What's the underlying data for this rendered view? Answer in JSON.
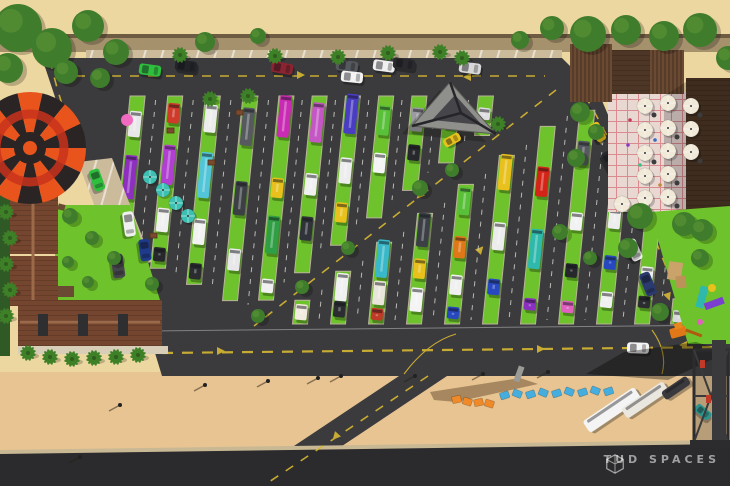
{
  "watermark": {
    "text": "TUD SPACES",
    "logo": "cube-outline-icon"
  },
  "palette": {
    "sand": "#ecd7a0",
    "beach": "#e7c492",
    "asphalt": "#3b3b3d",
    "asphalt_dark": "#2b2b2d",
    "grass": "#6ec22b",
    "concrete": "#cbbb9b",
    "wall": "#a5916c",
    "wall_edge": "#6d5c42",
    "roof_brown": "#74452f",
    "roof_dark": "#3e2c1e",
    "wood_slat": "#6b4a33",
    "plaza": "#e9d8d2",
    "plaza_line": "#d6787f",
    "lane_yellow": "#d8b832",
    "hedge": "#2f5a26",
    "tree": "#3f7d2c",
    "palm": "#3e8027",
    "umbrella_teal": "#3cc0b4",
    "umbrella_white": "#f0e9d8",
    "balloon_orange": "#e8541c",
    "balloon_dark": "#2a2524",
    "balloon_ring": "#c8321c",
    "letter_blue": "#45aede",
    "letter_orange": "#f08a28",
    "curb": "#c9b894",
    "sidewalk": "#d8cdb6"
  },
  "scene": {
    "balloon": {
      "cx": 30,
      "cy": 148,
      "r": 56,
      "gores": 14
    },
    "upper_grid": {
      "lean": 0.1,
      "strips": [
        {
          "x": 122,
          "t": [
            [
              0.18,
              26,
              "#e8e8ea"
            ],
            [
              0.52,
              44,
              "#8e2fc0"
            ],
            [
              0.85,
              18,
              "#2b2d31"
            ]
          ]
        },
        {
          "x": 158,
          "t": [
            [
              0.1,
              20,
              "#cf3a2a"
            ],
            [
              0.4,
              40,
              "#b13fd1"
            ],
            [
              0.72,
              24,
              "#f0f0f0"
            ],
            [
              0.92,
              14,
              "#26282c"
            ]
          ]
        },
        {
          "x": 194,
          "t": [
            [
              0.12,
              28,
              "#ececec"
            ],
            [
              0.42,
              46,
              "#52c6d8"
            ],
            [
              0.72,
              26,
              "#f2f2f2"
            ],
            [
              0.93,
              16,
              "#2a2c30"
            ]
          ]
        },
        {
          "x": 230,
          "t": [
            [
              0.15,
              38,
              "#565a5e"
            ],
            [
              0.5,
              34,
              "#3c4044"
            ],
            [
              0.8,
              22,
              "#e8e8ea"
            ]
          ]
        },
        {
          "x": 266,
          "t": [
            [
              0.1,
              42,
              "#c92bb4"
            ],
            [
              0.45,
              20,
              "#e8c11c"
            ],
            [
              0.68,
              38,
              "#2f9e44"
            ],
            [
              0.93,
              14,
              "#f0f0f0"
            ]
          ]
        },
        {
          "x": 302,
          "t": [
            [
              0.15,
              40,
              "#c457c4"
            ],
            [
              0.5,
              22,
              "#f0f0f0"
            ],
            [
              0.75,
              24,
              "#30343a"
            ]
          ]
        },
        {
          "x": 338,
          "t": [
            [
              0.12,
              40,
              "#4a3dc2"
            ],
            [
              0.5,
              26,
              "#ededed"
            ],
            [
              0.78,
              20,
              "#e8c11c"
            ]
          ]
        },
        {
          "x": 374,
          "t": [
            [
              0.2,
              30,
              "#59c03a"
            ],
            [
              0.55,
              20,
              "#f4f4f4"
            ]
          ]
        },
        {
          "x": 410,
          "t": [
            [
              0.25,
              24,
              "#9a9aa0"
            ],
            [
              0.6,
              16,
              "#26282c"
            ]
          ]
        },
        {
          "x": 446,
          "t": [
            [
              0.35,
              18,
              "#f0f0f0"
            ]
          ]
        },
        {
          "x": 482,
          "t": [
            [
              0.45,
              12,
              "#e0e0e2"
            ]
          ]
        }
      ]
    },
    "lower_grid": {
      "lean": 0.1,
      "strips": [
        {
          "x": 300,
          "t": [
            [
              0.5,
              20,
              "#f2ece0"
            ]
          ]
        },
        {
          "x": 338,
          "t": [
            [
              0.3,
              28,
              "#f0f0f0"
            ],
            [
              0.72,
              16,
              "#2b2d31"
            ]
          ]
        },
        {
          "x": 376,
          "t": [
            [
              0.2,
              38,
              "#38b8c8"
            ],
            [
              0.62,
              24,
              "#e9e5da"
            ],
            [
              0.88,
              12,
              "#c03a28"
            ]
          ]
        },
        {
          "x": 414,
          "t": [
            [
              0.15,
              34,
              "#3c4046"
            ],
            [
              0.5,
              20,
              "#e8c11c"
            ],
            [
              0.78,
              24,
              "#f4f4f4"
            ]
          ]
        },
        {
          "x": 452,
          "t": [
            [
              0.12,
              28,
              "#59c03a"
            ],
            [
              0.45,
              22,
              "#e07818"
            ],
            [
              0.72,
              20,
              "#f0f0f0"
            ],
            [
              0.92,
              12,
              "#2848c0"
            ]
          ]
        },
        {
          "x": 490,
          "t": [
            [
              0.1,
              36,
              "#e8c11c"
            ],
            [
              0.48,
              28,
              "#ececec"
            ],
            [
              0.78,
              16,
              "#2848c0"
            ]
          ]
        },
        {
          "x": 528,
          "t": [
            [
              0.28,
              30,
              "#d42418"
            ],
            [
              0.62,
              40,
              "#2fb9ac"
            ],
            [
              0.9,
              12,
              "#8a2fc0"
            ]
          ]
        },
        {
          "x": 566,
          "t": [
            [
              0.2,
              24,
              "#565a5e"
            ],
            [
              0.52,
              18,
              "#f2f2f2"
            ],
            [
              0.75,
              14,
              "#26282c"
            ],
            [
              0.92,
              12,
              "#e060c0"
            ]
          ]
        },
        {
          "x": 604,
          "t": [
            [
              0.35,
              20,
              "#ededed"
            ],
            [
              0.62,
              14,
              "#2848c0"
            ],
            [
              0.85,
              16,
              "#f0f0f0"
            ]
          ]
        },
        {
          "x": 642,
          "t": [
            [
              0.55,
              16,
              "#f0f0f0"
            ],
            [
              0.8,
              12,
              "#2b2d31"
            ]
          ]
        },
        {
          "x": 678,
          "t": [
            [
              0.7,
              12,
              "#d8d8dc"
            ]
          ]
        }
      ]
    },
    "top_parking_cars": [
      [
        150,
        70,
        8,
        "#2fbf3f"
      ],
      [
        186,
        66,
        8,
        "#222428"
      ],
      [
        282,
        68,
        10,
        "#8a2430"
      ],
      [
        347,
        66,
        8,
        "#55585c"
      ],
      [
        384,
        66,
        8,
        "#f0f0f0"
      ],
      [
        404,
        64,
        8,
        "#2a2a2e"
      ],
      [
        470,
        68,
        8,
        "#d8d8d8"
      ]
    ],
    "pad_cars": [
      [
        97,
        180,
        70,
        "#2fbf3f",
        22,
        11
      ],
      [
        129,
        224,
        82,
        "#f0f0f0",
        25,
        11
      ],
      [
        145,
        250,
        82,
        "#1e3a8a",
        22,
        11
      ],
      [
        118,
        266,
        82,
        "#44444a",
        24,
        12
      ]
    ],
    "right_road_cars": [
      [
        598,
        132,
        62,
        "#e8c11c",
        20,
        10
      ],
      [
        610,
        162,
        62,
        "#26282c",
        22,
        11
      ],
      [
        621,
        192,
        64,
        "#2848c0",
        22,
        11
      ],
      [
        634,
        250,
        66,
        "#f0f0f0",
        22,
        11
      ],
      [
        648,
        284,
        68,
        "#2b3a6e",
        24,
        11
      ]
    ],
    "road_cars": [
      [
        352,
        77,
        6,
        "#f4f4f4",
        22,
        11
      ],
      [
        638,
        348,
        2,
        "#f4f4f4",
        22,
        11
      ],
      [
        452,
        140,
        -28,
        "#e8c11c",
        18,
        9
      ],
      [
        703,
        412,
        40,
        "#2fb9ac",
        18,
        9
      ]
    ],
    "buses": [
      [
        612,
        410,
        -34,
        62,
        14,
        "#f4f4f4"
      ],
      [
        645,
        400,
        -34,
        50,
        12,
        "#e9e7e0"
      ],
      [
        676,
        388,
        -34,
        30,
        10,
        "#3a3a3e"
      ]
    ],
    "bushes": [
      [
        18,
        28,
        24
      ],
      [
        52,
        48,
        20
      ],
      [
        88,
        26,
        16
      ],
      [
        116,
        52,
        13
      ],
      [
        8,
        68,
        15
      ],
      [
        66,
        72,
        12
      ],
      [
        100,
        78,
        10
      ],
      [
        205,
        42,
        10
      ],
      [
        258,
        36,
        8
      ],
      [
        520,
        40,
        9
      ],
      [
        552,
        28,
        12
      ],
      [
        588,
        34,
        18
      ],
      [
        626,
        30,
        15
      ],
      [
        664,
        36,
        15
      ],
      [
        700,
        30,
        17
      ],
      [
        728,
        58,
        12
      ],
      [
        580,
        112,
        10
      ],
      [
        596,
        132,
        8
      ],
      [
        576,
        158,
        9
      ],
      [
        640,
        216,
        13
      ],
      [
        684,
        224,
        12
      ],
      [
        628,
        248,
        10
      ],
      [
        702,
        230,
        11
      ],
      [
        660,
        312,
        9
      ],
      [
        700,
        258,
        9
      ],
      [
        70,
        216,
        8
      ],
      [
        92,
        238,
        7
      ],
      [
        114,
        258,
        7
      ],
      [
        88,
        282,
        6
      ],
      [
        152,
        284,
        7
      ],
      [
        68,
        262,
        6
      ],
      [
        420,
        188,
        8
      ],
      [
        452,
        170,
        7
      ],
      [
        348,
        248,
        7
      ],
      [
        302,
        287,
        7
      ],
      [
        258,
        316,
        7
      ],
      [
        560,
        232,
        8
      ],
      [
        590,
        258,
        7
      ]
    ],
    "palms": [
      [
        180,
        55
      ],
      [
        275,
        56
      ],
      [
        338,
        57
      ],
      [
        388,
        53
      ],
      [
        440,
        52
      ],
      [
        462,
        58
      ],
      [
        6,
        212
      ],
      [
        10,
        238
      ],
      [
        6,
        264
      ],
      [
        10,
        290
      ],
      [
        6,
        316
      ],
      [
        28,
        353
      ],
      [
        50,
        357
      ],
      [
        72,
        359
      ],
      [
        94,
        358
      ],
      [
        116,
        357
      ],
      [
        138,
        355
      ],
      [
        210,
        99
      ],
      [
        248,
        96
      ],
      [
        498,
        124
      ]
    ],
    "umbrellas_teal": [
      [
        150,
        177
      ],
      [
        163,
        190
      ],
      [
        176,
        203
      ],
      [
        188,
        216
      ]
    ],
    "umbrellas_white": [
      [
        645,
        106
      ],
      [
        668,
        103
      ],
      [
        691,
        106
      ],
      [
        645,
        130
      ],
      [
        668,
        128
      ],
      [
        691,
        129
      ],
      [
        645,
        153
      ],
      [
        668,
        151
      ],
      [
        691,
        152
      ],
      [
        645,
        176
      ],
      [
        668,
        174
      ],
      [
        645,
        198
      ],
      [
        668,
        197
      ],
      [
        622,
        204
      ]
    ],
    "plaza_people": [
      [
        630,
        120,
        "#c03a5a"
      ],
      [
        655,
        140,
        "#3a6ac0"
      ],
      [
        640,
        165,
        "#3ac08a"
      ],
      [
        660,
        185,
        "#c08a3a"
      ],
      [
        628,
        145,
        "#8a3ac0"
      ]
    ],
    "picnic_tables": [
      [
        167,
        128
      ],
      [
        150,
        233
      ],
      [
        236,
        110
      ],
      [
        208,
        160
      ]
    ],
    "play_items": [
      [
        100,
        250
      ],
      [
        118,
        266
      ],
      [
        134,
        284
      ],
      [
        86,
        232
      ],
      [
        124,
        242
      ],
      [
        108,
        288
      ]
    ],
    "lamps": [
      [
        120,
        405
      ],
      [
        80,
        457
      ],
      [
        205,
        385
      ],
      [
        268,
        381
      ],
      [
        318,
        378
      ],
      [
        341,
        376
      ],
      [
        415,
        376
      ],
      [
        483,
        374
      ],
      [
        548,
        372
      ]
    ],
    "letters_orange": [
      [
        452,
        396
      ],
      [
        463,
        398
      ],
      [
        474,
        399
      ],
      [
        485,
        400
      ]
    ],
    "letters_blue": [
      [
        500,
        392
      ],
      [
        513,
        390
      ],
      [
        526,
        391
      ],
      [
        539,
        389
      ],
      [
        552,
        390
      ],
      [
        565,
        388
      ],
      [
        578,
        389
      ],
      [
        591,
        387
      ],
      [
        604,
        388
      ]
    ],
    "arrows": [
      [
        300,
        75,
        90
      ],
      [
        468,
        77,
        -90
      ],
      [
        220,
        351,
        90
      ],
      [
        540,
        349,
        90
      ],
      [
        684,
        345,
        -90
      ],
      [
        336,
        436,
        222
      ],
      [
        480,
        250,
        42
      ],
      [
        420,
        195,
        222
      ],
      [
        96,
        196,
        170
      ],
      [
        60,
        112,
        170
      ],
      [
        600,
        140,
        160
      ],
      [
        668,
        296,
        160
      ]
    ],
    "decor_pink_ball": [
      127,
      120
    ]
  }
}
